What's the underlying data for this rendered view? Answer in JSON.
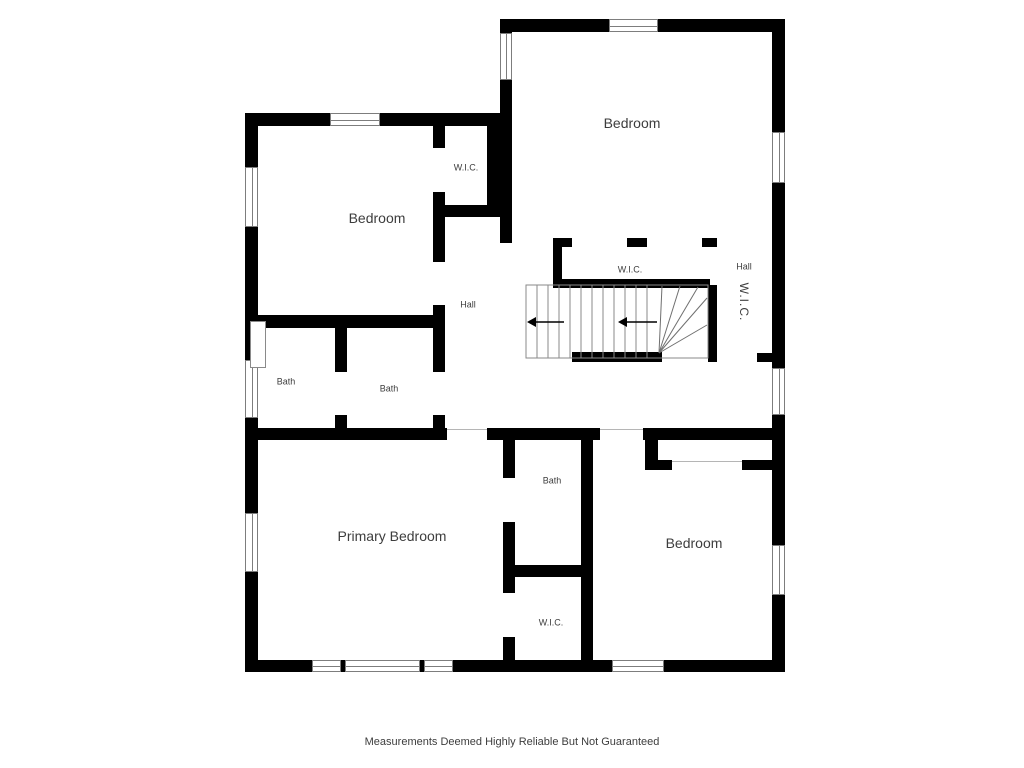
{
  "footer": {
    "text": "Measurements Deemed Highly Reliable But Not Guaranteed"
  },
  "colors": {
    "wall": "#000000",
    "window_line": "#7d7d7d",
    "opening_line": "#b5b5b5",
    "stair_line": "#8a8a8a",
    "label_text": "#3d3d3d",
    "background": "#ffffff"
  },
  "floorplan": {
    "labels": [
      {
        "id": "bedroom-top-left",
        "text": "Bedroom",
        "x": 377,
        "y": 218,
        "size": 14
      },
      {
        "id": "wic-top-left",
        "text": "W.I.C.",
        "x": 466,
        "y": 168,
        "size": 9
      },
      {
        "id": "bedroom-top-right",
        "text": "Bedroom",
        "x": 632,
        "y": 123,
        "size": 14
      },
      {
        "id": "wic-middle",
        "text": "W.I.C.",
        "x": 630,
        "y": 270,
        "size": 9
      },
      {
        "id": "hall-right",
        "text": "Hall",
        "x": 744,
        "y": 267,
        "size": 9
      },
      {
        "id": "wic-right-rotated",
        "text": "W.I.C.",
        "x": 744,
        "y": 302,
        "size": 12,
        "rotate": 90
      },
      {
        "id": "hall-left",
        "text": "Hall",
        "x": 468,
        "y": 305,
        "size": 9
      },
      {
        "id": "bath-left",
        "text": "Bath",
        "x": 286,
        "y": 382,
        "size": 9
      },
      {
        "id": "bath-middle",
        "text": "Bath",
        "x": 389,
        "y": 389,
        "size": 9
      },
      {
        "id": "primary-bedroom",
        "text": "Primary Bedroom",
        "x": 392,
        "y": 536,
        "size": 14
      },
      {
        "id": "bath-bottom",
        "text": "Bath",
        "x": 552,
        "y": 481,
        "size": 9
      },
      {
        "id": "wic-bottom",
        "text": "W.I.C.",
        "x": 551,
        "y": 623,
        "size": 9
      },
      {
        "id": "bedroom-bottom-right",
        "text": "Bedroom",
        "x": 694,
        "y": 543,
        "size": 14
      }
    ],
    "walls": [
      [
        500,
        19,
        285,
        13
      ],
      [
        772,
        19,
        13,
        113
      ],
      [
        772,
        183,
        13,
        185
      ],
      [
        772,
        415,
        13,
        130
      ],
      [
        772,
        595,
        13,
        77
      ],
      [
        245,
        660,
        67,
        12
      ],
      [
        341,
        660,
        4,
        12
      ],
      [
        420,
        660,
        4,
        12
      ],
      [
        453,
        660,
        159,
        12
      ],
      [
        664,
        660,
        121,
        12
      ],
      [
        245,
        113,
        13,
        54
      ],
      [
        245,
        227,
        13,
        133
      ],
      [
        245,
        418,
        13,
        95
      ],
      [
        245,
        572,
        13,
        88
      ],
      [
        245,
        113,
        85,
        13
      ],
      [
        380,
        113,
        120,
        13
      ],
      [
        500,
        19,
        12,
        14
      ],
      [
        500,
        80,
        12,
        35
      ],
      [
        487,
        113,
        25,
        100
      ],
      [
        500,
        213,
        12,
        30
      ],
      [
        433,
        113,
        12,
        35
      ],
      [
        433,
        192,
        12,
        25
      ],
      [
        433,
        205,
        79,
        12
      ],
      [
        433,
        217,
        12,
        45
      ],
      [
        433,
        305,
        12,
        67
      ],
      [
        433,
        415,
        12,
        25
      ],
      [
        245,
        315,
        200,
        13
      ],
      [
        335,
        315,
        12,
        57
      ],
      [
        335,
        415,
        12,
        25
      ],
      [
        245,
        428,
        202,
        12
      ],
      [
        487,
        428,
        113,
        12
      ],
      [
        643,
        428,
        129,
        12
      ],
      [
        503,
        440,
        12,
        38
      ],
      [
        503,
        522,
        12,
        71
      ],
      [
        503,
        637,
        12,
        23
      ],
      [
        581,
        428,
        12,
        232
      ],
      [
        503,
        565,
        90,
        12
      ],
      [
        645,
        440,
        13,
        30
      ],
      [
        658,
        460,
        14,
        10
      ],
      [
        742,
        460,
        31,
        10
      ],
      [
        553,
        238,
        19,
        9
      ],
      [
        627,
        238,
        20,
        9
      ],
      [
        702,
        238,
        15,
        9
      ],
      [
        553,
        238,
        9,
        50
      ],
      [
        553,
        279,
        157,
        9
      ],
      [
        708,
        285,
        9,
        77
      ],
      [
        572,
        352,
        90,
        10
      ],
      [
        757,
        353,
        16,
        9
      ]
    ],
    "windows": [
      {
        "x": 330,
        "y": 113,
        "w": 50,
        "h": 13,
        "o": "h"
      },
      {
        "x": 609,
        "y": 19,
        "w": 49,
        "h": 13,
        "o": "h"
      },
      {
        "x": 500,
        "y": 33,
        "w": 12,
        "h": 47,
        "o": "v"
      },
      {
        "x": 772,
        "y": 132,
        "w": 13,
        "h": 51,
        "o": "v"
      },
      {
        "x": 772,
        "y": 368,
        "w": 13,
        "h": 47,
        "o": "v"
      },
      {
        "x": 772,
        "y": 545,
        "w": 13,
        "h": 50,
        "o": "v"
      },
      {
        "x": 245,
        "y": 167,
        "w": 13,
        "h": 60,
        "o": "v"
      },
      {
        "x": 245,
        "y": 360,
        "w": 13,
        "h": 58,
        "o": "v"
      },
      {
        "x": 245,
        "y": 513,
        "w": 13,
        "h": 59,
        "o": "v"
      },
      {
        "x": 312,
        "y": 660,
        "w": 29,
        "h": 12,
        "o": "h"
      },
      {
        "x": 345,
        "y": 660,
        "w": 75,
        "h": 12,
        "o": "h"
      },
      {
        "x": 424,
        "y": 660,
        "w": 29,
        "h": 12,
        "o": "h"
      },
      {
        "x": 612,
        "y": 660,
        "w": 52,
        "h": 12,
        "o": "h"
      }
    ],
    "openings": [
      {
        "x1": 447,
        "y1": 429,
        "x2": 487,
        "y2": 429
      },
      {
        "x1": 600,
        "y1": 429,
        "x2": 643,
        "y2": 429
      },
      {
        "x1": 672,
        "y1": 461,
        "x2": 742,
        "y2": 461
      }
    ],
    "fixtures": [
      {
        "type": "shower",
        "x": 250,
        "y": 321,
        "w": 16,
        "h": 47
      }
    ],
    "stairs": {
      "outline": {
        "x": 526,
        "y": 285,
        "w": 182,
        "h": 73
      },
      "treads_x": [
        537,
        548,
        559,
        570,
        581,
        592,
        603,
        614,
        625,
        636,
        647
      ],
      "tread_y1": 285,
      "tread_y2": 358,
      "winder_lines": [
        [
          659,
          353,
          662,
          286
        ],
        [
          659,
          353,
          680,
          286
        ],
        [
          659,
          353,
          698,
          287
        ],
        [
          659,
          353,
          707,
          298
        ],
        [
          659,
          353,
          707,
          325
        ]
      ],
      "arrows": [
        {
          "tip_x": 527,
          "tip_y": 322,
          "tail": 28
        },
        {
          "tip_x": 618,
          "tip_y": 322,
          "tail": 30
        }
      ]
    }
  }
}
